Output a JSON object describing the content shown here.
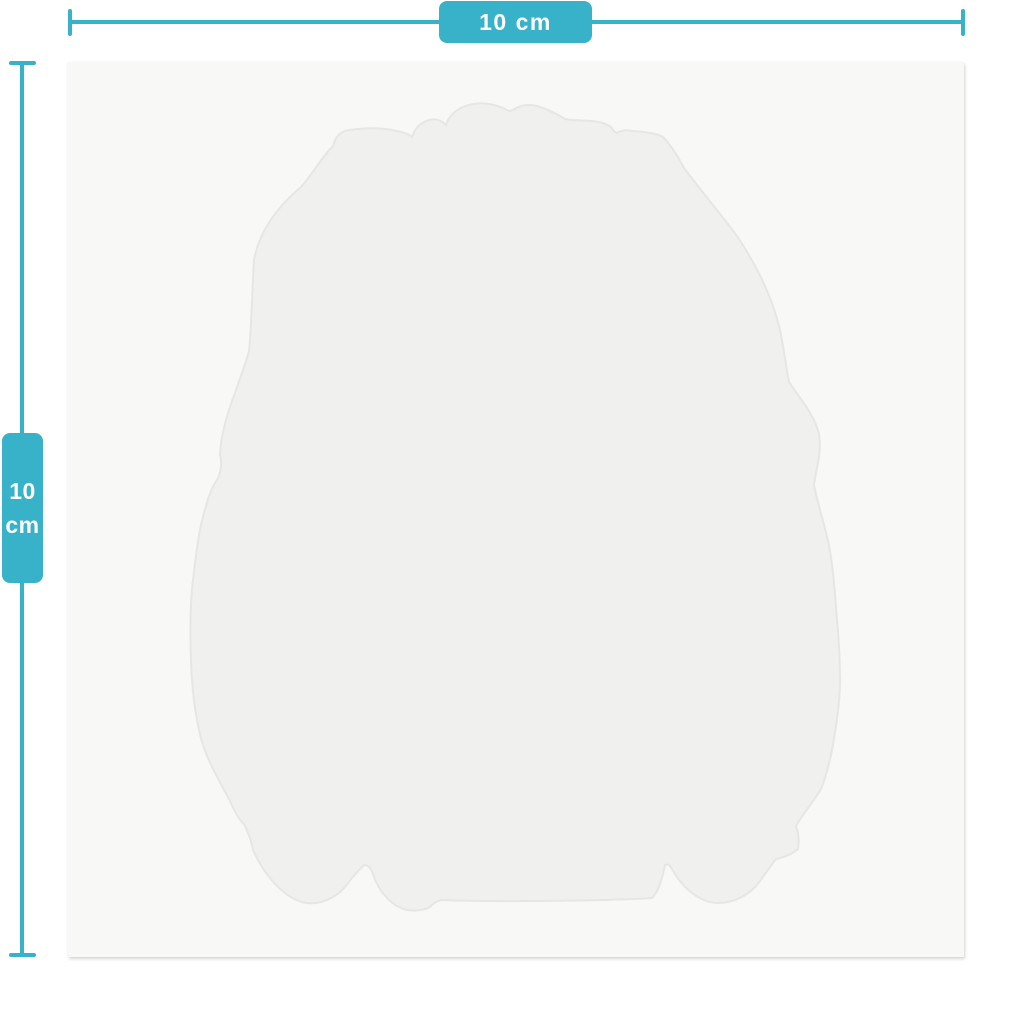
{
  "measurements": {
    "width": {
      "label": "10 cm"
    },
    "height": {
      "value": "10",
      "unit": "cm"
    }
  },
  "colors": {
    "accent_teal": "#38b2c8",
    "label_text": "#ffffff",
    "background": "#ffffff",
    "sheet": "#f8f8f7",
    "die_cut_fill": "#f0f0ee",
    "die_cut_edge": "#e6e6e3"
  }
}
